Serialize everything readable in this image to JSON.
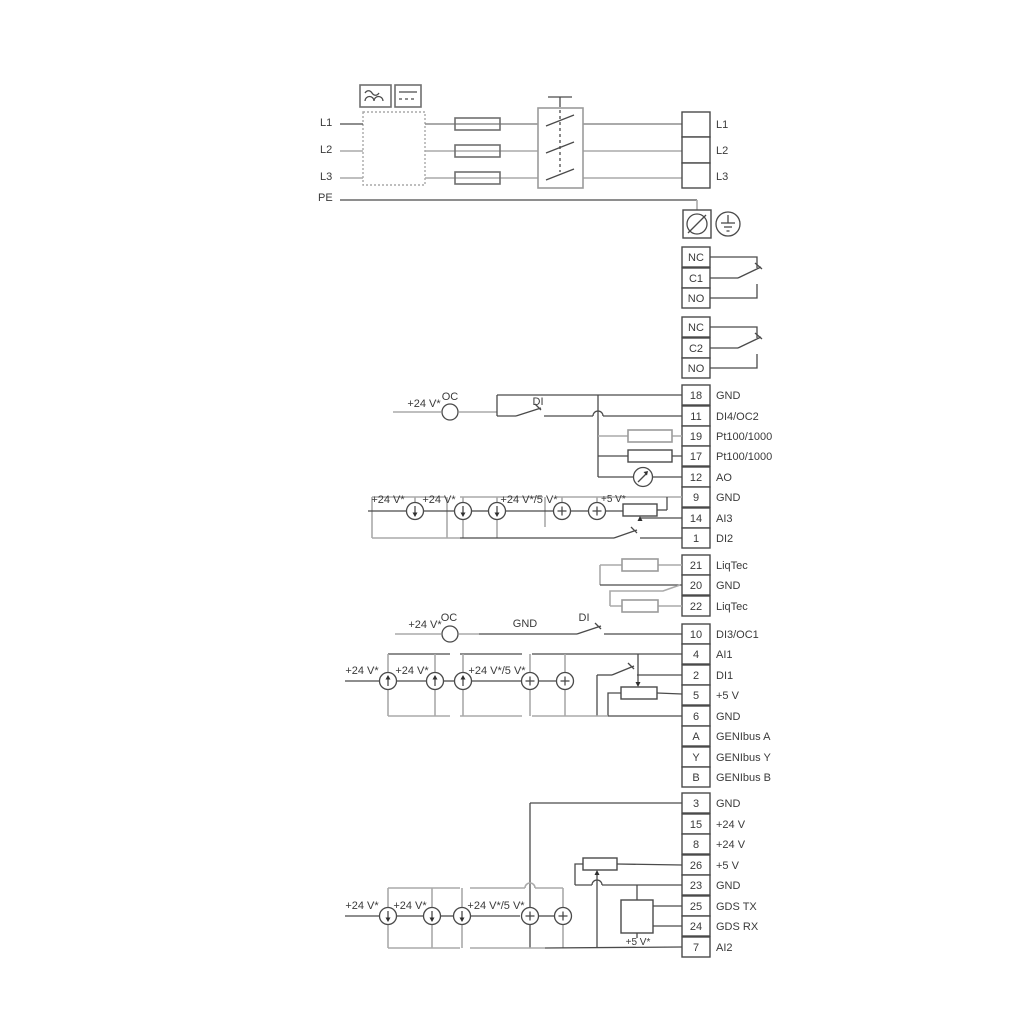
{
  "diagram": {
    "power": {
      "left": [
        "L1",
        "L2",
        "L3",
        "PE"
      ],
      "right": [
        "L1",
        "L2",
        "L3"
      ]
    },
    "relays": [
      {
        "rows": [
          "NC",
          "C1",
          "NO"
        ]
      },
      {
        "rows": [
          "NC",
          "C2",
          "NO"
        ]
      }
    ],
    "strips": {
      "io1": [
        {
          "n": "18",
          "l": "GND"
        },
        {
          "n": "11",
          "l": "DI4/OC2"
        },
        {
          "n": "19",
          "l": "Pt100/1000"
        },
        {
          "n": "17",
          "l": "Pt100/1000"
        },
        {
          "n": "12",
          "l": "AO"
        },
        {
          "n": "9",
          "l": "GND"
        },
        {
          "n": "14",
          "l": "AI3"
        },
        {
          "n": "1",
          "l": "DI2"
        }
      ],
      "liqtec": [
        {
          "n": "21",
          "l": "LiqTec"
        },
        {
          "n": "20",
          "l": "GND"
        },
        {
          "n": "22",
          "l": "LiqTec"
        }
      ],
      "io2": [
        {
          "n": "10",
          "l": "DI3/OC1"
        },
        {
          "n": "4",
          "l": "AI1"
        },
        {
          "n": "2",
          "l": "DI1"
        },
        {
          "n": "5",
          "l": "+5 V"
        },
        {
          "n": "6",
          "l": "GND"
        },
        {
          "n": "A",
          "l": "GENIbus A"
        },
        {
          "n": "Y",
          "l": "GENIbus Y"
        },
        {
          "n": "B",
          "l": "GENIbus B"
        }
      ],
      "io3": [
        {
          "n": "3",
          "l": "GND"
        },
        {
          "n": "15",
          "l": "+24 V"
        },
        {
          "n": "8",
          "l": "+24 V"
        },
        {
          "n": "26",
          "l": "+5 V"
        },
        {
          "n": "23",
          "l": "GND"
        },
        {
          "n": "25",
          "l": "GDS TX"
        },
        {
          "n": "24",
          "l": "GDS RX"
        },
        {
          "n": "7",
          "l": "AI2"
        }
      ]
    },
    "ann": {
      "ai3": {
        "v24": "+24 V*",
        "oc": "OC",
        "di": "DI",
        "s1": "+24 V*",
        "s2": "+24 V*",
        "s45": "+24 V*/5 V*",
        "s5": "+5 V*"
      },
      "di3": {
        "v24": "+24 V*",
        "oc": "OC",
        "gnd": "GND",
        "di": "DI"
      },
      "ai1": {
        "s1": "+24 V*",
        "s2": "+24 V*",
        "s45": "+24 V*/5 V*"
      },
      "ai2": {
        "s1": "+24 V*",
        "s2": "+24 V*",
        "s45": "+24 V*/5 V*",
        "v5": "+5 V*"
      }
    },
    "colors": {
      "wire_dark": "#4a4a4a",
      "wire_gray": "#aaaaaa",
      "text": "#3a3a3a",
      "background": "#ffffff"
    }
  }
}
